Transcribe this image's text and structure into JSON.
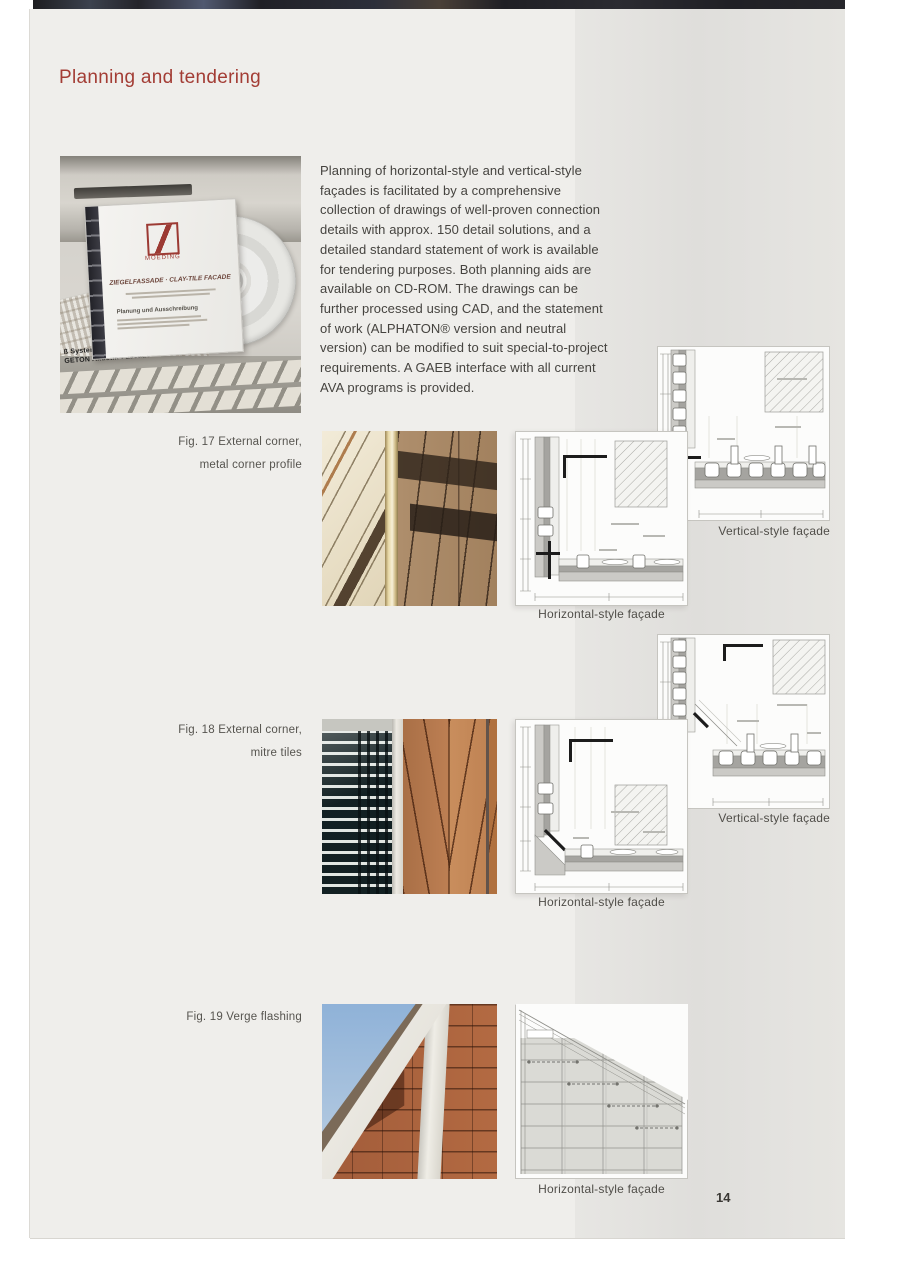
{
  "header": {
    "title": "Planning and tendering"
  },
  "intro": {
    "text": "Planning of horizontal-style and vertical-style façades is facilitated by a comprehensive collection of drawings of well-proven connection details with approx. 150 detail solutions, and a detailed standard statement of work is available for tendering purposes. Both planning aids are available on CD-ROM. The drawings can be further processed using CAD, and the statement of work (ALPHATON® version and neutral version) can be modified to suit special-to-project requirements. A GAEB interface with all current AVA programs is provided."
  },
  "cd_photo": {
    "brand": "MOEDING",
    "cover_title": "ZIEGELFASSADE · CLAY-TILE FACADE",
    "cover_subtitle": "Planung und Ausschreibung",
    "keyboard_caption_line1": "ß Systemhaus, Aachen",
    "keyboard_caption_line2": "GETON Akustik-Fassade"
  },
  "figures": {
    "fig17": {
      "caption_line1": "Fig. 17  External corner,",
      "caption_line2": "metal corner profile",
      "vertical_label": "Vertical-style façade",
      "horizontal_label": "Horizontal-style façade"
    },
    "fig18": {
      "caption_line1": "Fig. 18  External corner,",
      "caption_line2": "mitre tiles",
      "vertical_label": "Vertical-style façade",
      "horizontal_label": "Horizontal-style façade"
    },
    "fig19": {
      "caption_line1": "Fig. 19  Verge flashing",
      "horizontal_label": "Horizontal-style façade"
    }
  },
  "footer": {
    "page_number": "14"
  },
  "colors": {
    "accent": "#a33d35",
    "page_bg": "#efeeeb",
    "shade_column": "#e2e1de"
  }
}
